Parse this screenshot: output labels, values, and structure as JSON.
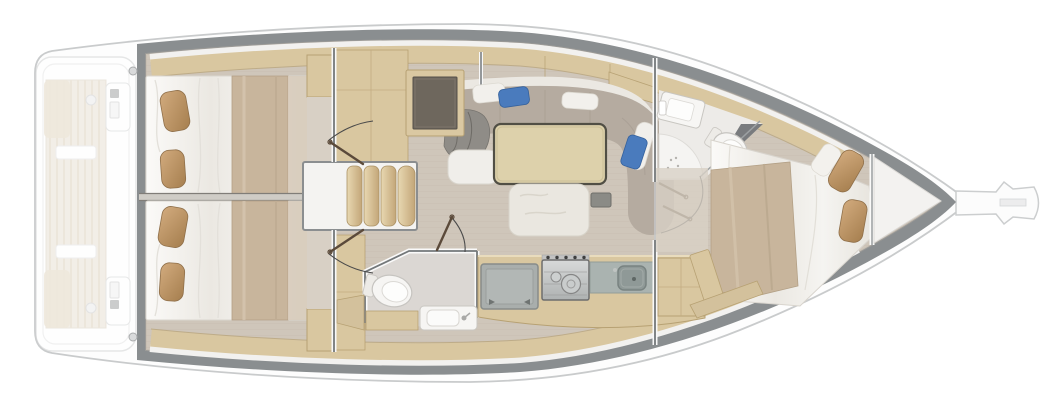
{
  "figure": {
    "kind": "sailboat-interior-floor-plan-top-view",
    "bow_direction": "right",
    "stern_direction": "left"
  },
  "rooms": [
    {
      "id": "cockpit-stern",
      "style": "ghosted",
      "items": [
        "swim-platform",
        "cockpit-table",
        "teak-deck",
        "twin-helm-consoles",
        "winches"
      ]
    },
    {
      "id": "aft-cabin-port",
      "items": [
        "double-bed",
        "two-pillows",
        "blanket",
        "hull-shelf",
        "cabinet"
      ]
    },
    {
      "id": "aft-cabin-starboard",
      "items": [
        "double-bed",
        "two-pillows",
        "blanket",
        "hull-shelf",
        "cabinet"
      ]
    },
    {
      "id": "companionway",
      "items": [
        "landing",
        "steps-four-treads",
        "cabin-door-port",
        "cabin-door-starboard"
      ]
    },
    {
      "id": "saloon",
      "items": [
        "l-shaped-settee",
        "back-cushions",
        "blue-pillows",
        "white-pillows",
        "gray-throw",
        "nav-desk",
        "dining-table",
        "center-bench",
        "small-tray"
      ]
    },
    {
      "id": "aft-head",
      "items": [
        "toilet",
        "vanity-sink",
        "door-with-swing-arc",
        "locker"
      ]
    },
    {
      "id": "galley",
      "items": [
        "top-loading-fridge",
        "two-burner-stove",
        "sink",
        "counter",
        "cabinet"
      ]
    },
    {
      "id": "forward-head",
      "items": [
        "sink",
        "toilet",
        "corner-shower",
        "folding-door",
        "mirror-wall"
      ]
    },
    {
      "id": "forward-cabin",
      "items": [
        "island-double-bed",
        "two-pillows",
        "blanket",
        "side-shelf",
        "foot-locker"
      ]
    },
    {
      "id": "bow",
      "items": [
        "anchor-locker",
        "bowsprit-with-anchor-roller"
      ]
    }
  ],
  "colors": {
    "hull-band": "#8a8e90",
    "hull-line": "#c9cbcc",
    "floor": "#cfc6ba",
    "plank": "#c2b8ab",
    "wood": "#d9c7a0",
    "wood-edge": "#b7a173",
    "bed": "#f1efe9",
    "blanket": "#c8b59c",
    "pillow": "#c29d72",
    "settee": "#b5aba0",
    "backrest": "#ebe8e2",
    "cushion-gray": "#8f8c87",
    "table": "#ddd1ab",
    "table-edge": "#514f45",
    "desk": "#6e675d",
    "step": "#d5bd8d",
    "blue": "#4a7bbd",
    "steel": "#c5c8c8",
    "counter": "#aab3b0",
    "sink": "#8f9997",
    "fridge": "#a9aeac",
    "wall": "#74787a",
    "fixture": "#f6f5f3",
    "fixture-edge": "#c6c4c0",
    "door-leaf": "#5b4a3a",
    "swing-arc": "#4a4a4a",
    "ghost-wood": "#eae3d6"
  }
}
